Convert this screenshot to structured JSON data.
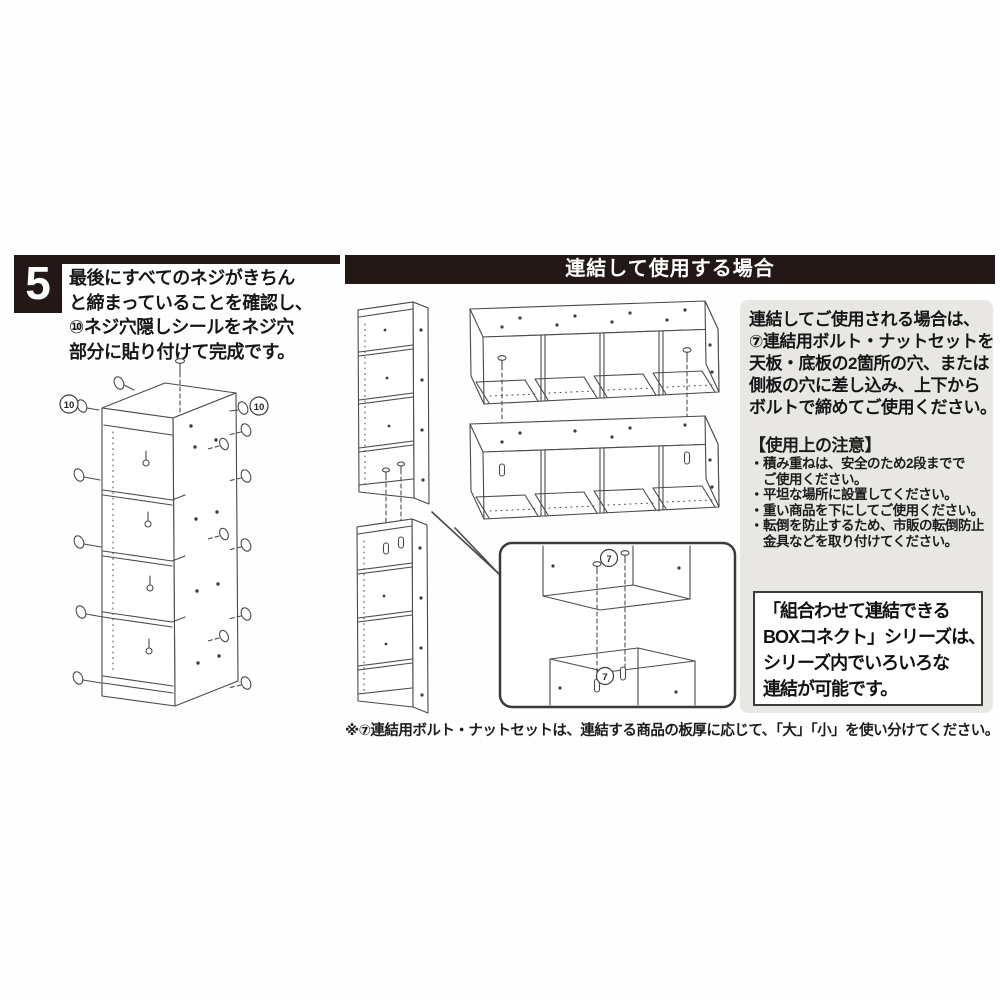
{
  "step": {
    "number": "5",
    "lines": [
      "最後にすべてのネジがきちん",
      "と締まっていることを確認し、",
      "⑩ネジ穴隠しシールをネジ穴",
      "部分に貼り付けて完成です。"
    ]
  },
  "header": {
    "title": "連結して使用する場合"
  },
  "diagram": {
    "sticker_badge": "10",
    "bolt_badge": "7",
    "left_diagram_desc": "completed-shelf-with-screw-hole-stickers",
    "middle_diagram_desc": "units-connected-with-bolts-and-nuts"
  },
  "panel": {
    "intro_lines": [
      "連結してご使用される場合は、",
      "⑦連結用ボルト・ナットセットを",
      "天板・底板の2箇所の穴、または",
      "側板の穴に差し込み、上下から",
      "ボルトで締めてご使用ください。"
    ],
    "caution_title": "【使用上の注意】",
    "caution_lines": [
      "・積み重ねは、安全のため2段までで",
      "　ご使用ください。",
      "・平坦な場所に設置してください。",
      "・重い商品を下にしてご使用ください。",
      "・転倒を防止するため、市販の転倒防止",
      "　金具などを取り付けてください。"
    ],
    "series_lines": [
      "「組合わせて連結できる",
      "BOXコネクト」シリーズは、",
      "シリーズ内でいろいろな",
      "連結が可能です。"
    ]
  },
  "footnote": "※⑦連結用ボルト・ナットセットは、連結する商品の板厚に応じて、「大」「小」を使い分けてください。",
  "colors": {
    "ink": "#231815",
    "panel_bg": "#e8e7e4",
    "line": "#4a4a4a"
  }
}
